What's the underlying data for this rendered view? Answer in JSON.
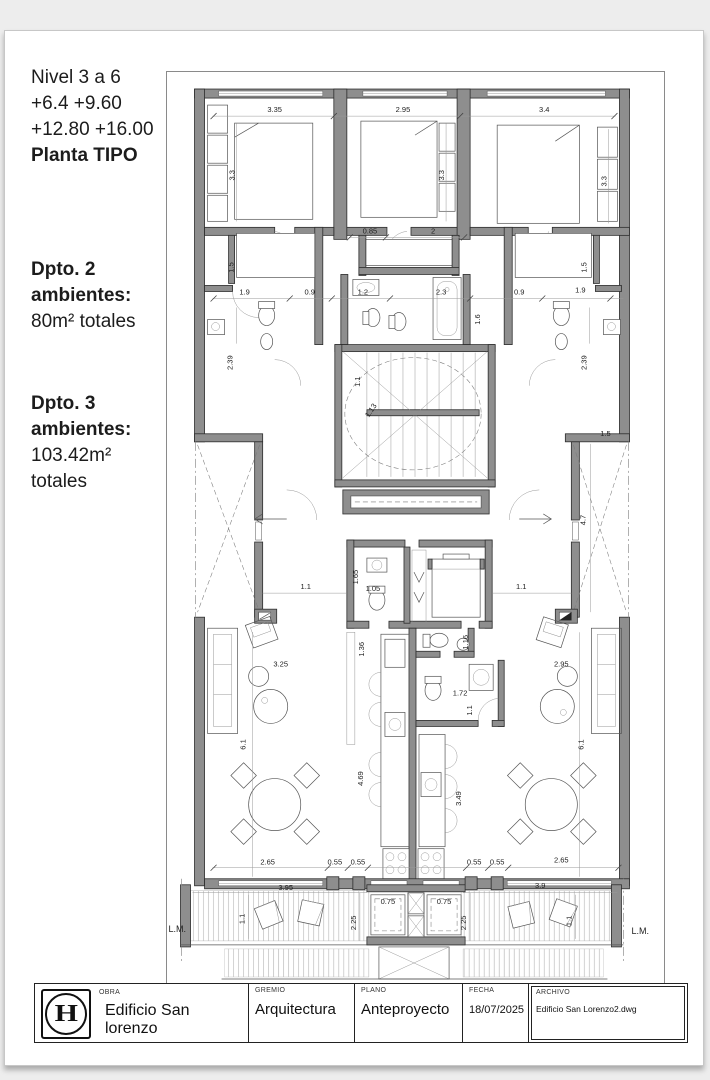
{
  "notes": {
    "line1": "Nivel 3 a 6",
    "line2": "+6.4 +9.60",
    "line3": "+12.80 +16.00",
    "line4": "Planta TIPO",
    "dpto2_t1": "Dpto. 2",
    "dpto2_t2": "ambientes:",
    "dpto2_area": "80m² totales",
    "dpto3_t1": "Dpto. 3",
    "dpto3_t2": "ambientes:",
    "dpto3_area": "103.42m²",
    "dpto3_area2": "totales"
  },
  "titleblock": {
    "logo_letter": "H",
    "obra_label": "OBRA",
    "obra_value": "Edificio San lorenzo",
    "gremio_label": "GREMIO",
    "gremio_value": "Arquitectura",
    "plano_label": "PLANO",
    "plano_value": "Anteproyecto",
    "fecha_label": "FECHA",
    "fecha_value": "18/07/2025",
    "archivo_label": "ARCHIVO",
    "archivo_value": "Edificio San Lorenzo2.dwg"
  },
  "plan": {
    "dims": {
      "t335": "3.35",
      "t295": "2.95",
      "t34": "3.4",
      "bed33l": "3.3",
      "bed33c": "3.3",
      "bed33r": "3.3",
      "t085": "0.85",
      "t2": "2",
      "m19l": "1.9",
      "m09l": "0.9",
      "m12": "1.2",
      "m23": "2.3",
      "m09r": "0.9",
      "m19r": "1.9",
      "m15l": "1.5",
      "m15r": "1.5",
      "m239l": "2.39",
      "m239r": "2.39",
      "m16": "1.6",
      "s11": "1.1",
      "s113": "1.13",
      "sh15": "1.5",
      "sh47": "4.7",
      "h11l": "1.1",
      "h11r": "1.1",
      "e165": "1.65",
      "e105": "1.05",
      "k136": "1.36",
      "k116": "1.16",
      "k172": "1.72",
      "k11": "1.1",
      "k469": "4.69",
      "k349": "3.49",
      "l325": "3.25",
      "l295": "2.95",
      "l61l": "6.1",
      "l61r": "6.1",
      "b265l": "2.65",
      "b055a": "0.55",
      "b055b": "0.55",
      "b055c": "0.55",
      "b055d": "0.55",
      "b265r": "2.65",
      "bal395": "3.95",
      "bal075l": "0.75",
      "bal075r": "0.75",
      "bal39": "3.9",
      "bal11l": "1.1",
      "bal11r": "1.1",
      "bal225l": "2.25",
      "bal225r": "2.25",
      "lml": "L.M.",
      "lmr": "L.M."
    }
  }
}
